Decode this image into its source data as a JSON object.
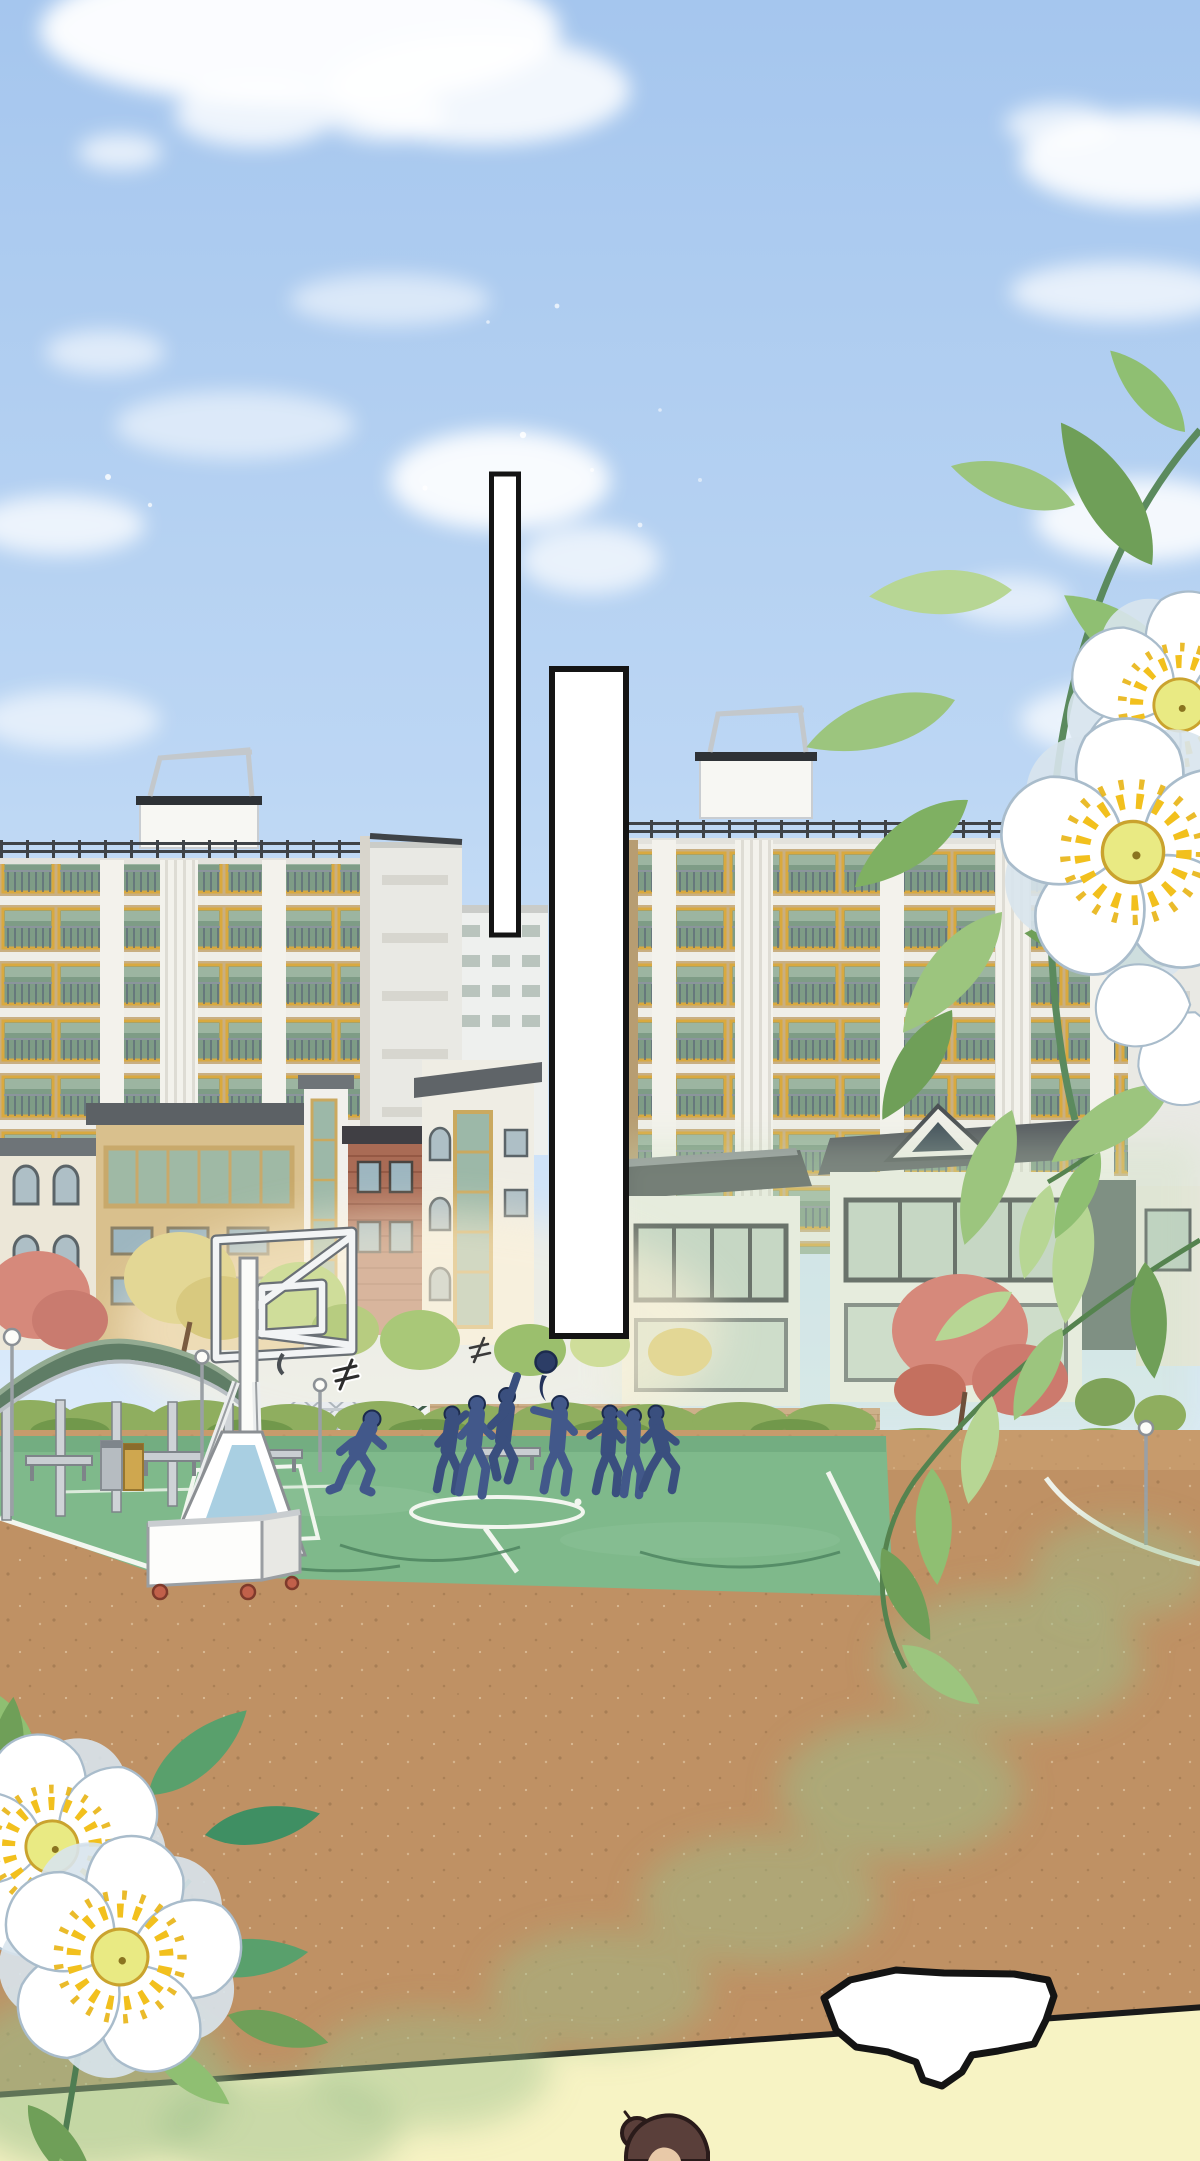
{
  "panel": {
    "type": "webtoon-panel",
    "speech_panels": [
      {
        "name": "vertical-panel-1",
        "text": ""
      },
      {
        "name": "vertical-panel-2",
        "text": ""
      },
      {
        "name": "burst-bubble-bottom",
        "text": ""
      }
    ],
    "figures": {
      "players_on_court": 8,
      "ball_in_air": true
    }
  },
  "colors": {
    "sky_top": "#a5c6ee",
    "sky_mid": "#bdd7f4",
    "sky_low": "#ddecfb",
    "cloud": "#ffffff",
    "building_tan": "#c9af82",
    "building_slab": "#efeee8",
    "window_frame_yellow": "#d9a93f",
    "window_glass_green": "#7e9c86",
    "pilaster_white": "#f3f2ec",
    "roof_rail_dark": "#3f4347",
    "side_wall": "#e9e9e4",
    "lowrise_cream": "#ece7d8",
    "brick_red": "#a96b55",
    "roof_grey": "#5f6468",
    "hedge_green": "#8fae5f",
    "tree_pink": "#d6897b",
    "tree_yellow": "#e3d795",
    "court_green": "#7fb98b",
    "court_line": "#f2f6ef",
    "dirt_brown": "#bf9164",
    "pavement_yellow": "#f7f3c4",
    "boundary_line": "#1a1a1a",
    "hoop_white": "#f2f4f5",
    "hoop_base_blue": "#a9cfe2",
    "wheel_red": "#c1604a",
    "silhouette_blue": "#42588a",
    "silhouette_outline": "#1c2b4d",
    "leaf_green": "#9cc57e",
    "leaf_dark": "#6f9f58",
    "stem_green": "#4f7d52",
    "petal_white": "#ffffff",
    "petal_shade": "#d9e5ee",
    "stamen_yellow": "#f2c01d",
    "pistil_yellow": "#e9ea83",
    "bubble_fill": "#ffffff",
    "bubble_stroke": "#141414",
    "hair_brown": "#5a3f3a",
    "skin": "#e8c9a8",
    "pergola_roof": "#5f7d66",
    "bin_steel": "#b6bcc1",
    "bin_yellow": "#cfa74f"
  }
}
